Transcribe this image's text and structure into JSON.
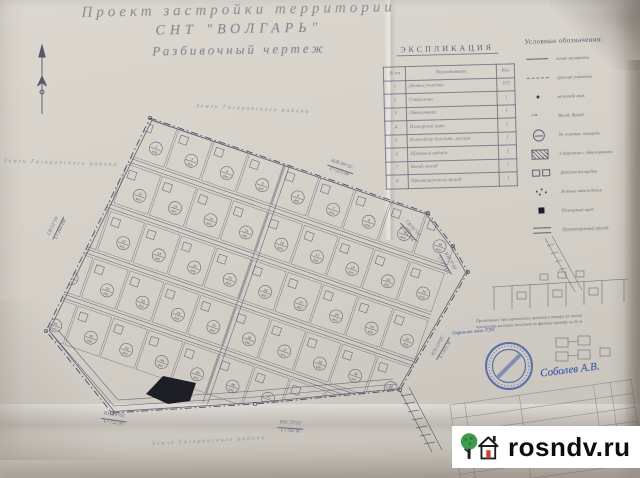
{
  "photo": {
    "paper_color": "#d6d2ca",
    "cloth_color": "#9c8164",
    "ink_color": "#5e6272",
    "pencil_color": "#8c8c9a",
    "blue_ink": "#3b55a8"
  },
  "title": {
    "line1": "Проект  застройки  территории",
    "line2": "СНТ  \"ВОЛГАРЬ\"",
    "line3": "Разбивочный  чертеж"
  },
  "explication": {
    "title": "ЭКСПЛИКАЦИЯ",
    "columns": [
      "№ пп",
      "Наименование",
      "Кол"
    ],
    "rows": [
      {
        "n": "1",
        "name": "Дачные участки",
        "qty": "319"
      },
      {
        "n": "2",
        "name": "Сторожка",
        "qty": "1"
      },
      {
        "n": "3",
        "name": "Обвалование",
        "qty": "1"
      },
      {
        "n": "4",
        "name": "Пожарный щит",
        "qty": "1"
      },
      {
        "n": "5",
        "name": "Контейнер для быт. мусора",
        "qty": "1"
      },
      {
        "n": "6",
        "name": "Щитовой водоём",
        "qty": "1"
      },
      {
        "n": "7",
        "name": "Въезд, выезд",
        "qty": "1"
      },
      {
        "n": "8",
        "name": "Проектируемый проезд",
        "qty": "1"
      }
    ]
  },
  "legend": {
    "title": "Условные обозначения:",
    "items": [
      {
        "symbol": "line-solid",
        "label": "линия застройки"
      },
      {
        "symbol": "line-thin",
        "label": "граница участков"
      },
      {
        "symbol": "dot",
        "label": "межевой знак"
      },
      {
        "symbol": "arrow",
        "label": "Въезд, Выезд"
      },
      {
        "symbol": "circle-number",
        "label": "№ участка, площадь"
      },
      {
        "symbol": "hatched",
        "label": "Сторожка с обвалованием"
      },
      {
        "symbol": "squares",
        "label": "Детская площадка"
      },
      {
        "symbol": "dots",
        "label": "Зелёные насаждения"
      },
      {
        "symbol": "black-square",
        "label": "Пожарный щит"
      },
      {
        "symbol": "road",
        "label": "Проектируемый проезд"
      }
    ]
  },
  "map": {
    "edge_labels": [
      {
        "line1": "ЮВ 49°35'",
        "line2": "L=223.94"
      },
      {
        "line1": "СВ 81°10'",
        "line2": "L=33.4М"
      },
      {
        "line1": "ЮВ 8°10'",
        "line2": "L=17.4М"
      },
      {
        "line1": "ЮЗ 33°05'",
        "line2": "L=101 М"
      },
      {
        "line1": "ЮЗ 73°15'",
        "line2": "L=142 М"
      },
      {
        "line1": "ЮЗ 16°05'",
        "line2": "L=152.99"
      },
      {
        "line1": "СВ 53°19'",
        "line2": "L=260.4М"
      }
    ],
    "area_labels": [
      "Земли Гагаринского района",
      "Земли Гагаринского района",
      "Земли Гагаринского района"
    ],
    "plot_area": "600",
    "plots": [
      "1",
      "2",
      "3",
      "4",
      "5",
      "6",
      "7",
      "8",
      "9",
      "10",
      "11",
      "12",
      "13",
      "14",
      "15",
      "16",
      "17",
      "18",
      "19",
      "20",
      "21",
      "22",
      "23",
      "24",
      "25",
      "26",
      "27",
      "28",
      "29",
      "30",
      "31",
      "32",
      "33",
      "34",
      "35",
      "36",
      "37",
      "38",
      "39",
      "40",
      "41",
      "42",
      "43",
      "44",
      "45",
      "46",
      "47",
      "48",
      "49",
      "50"
    ]
  },
  "annotations": {
    "lep_zone": "Охранная зона ЛЭП",
    "signature": "Соболев А.В.",
    "note_line1": "Примечание: при перенесении проекта в натуру за основу",
    "note_line2": "принимать размеры участков по фронту проезда по 20 м"
  },
  "watermark": {
    "text": "rosndv.ru"
  }
}
